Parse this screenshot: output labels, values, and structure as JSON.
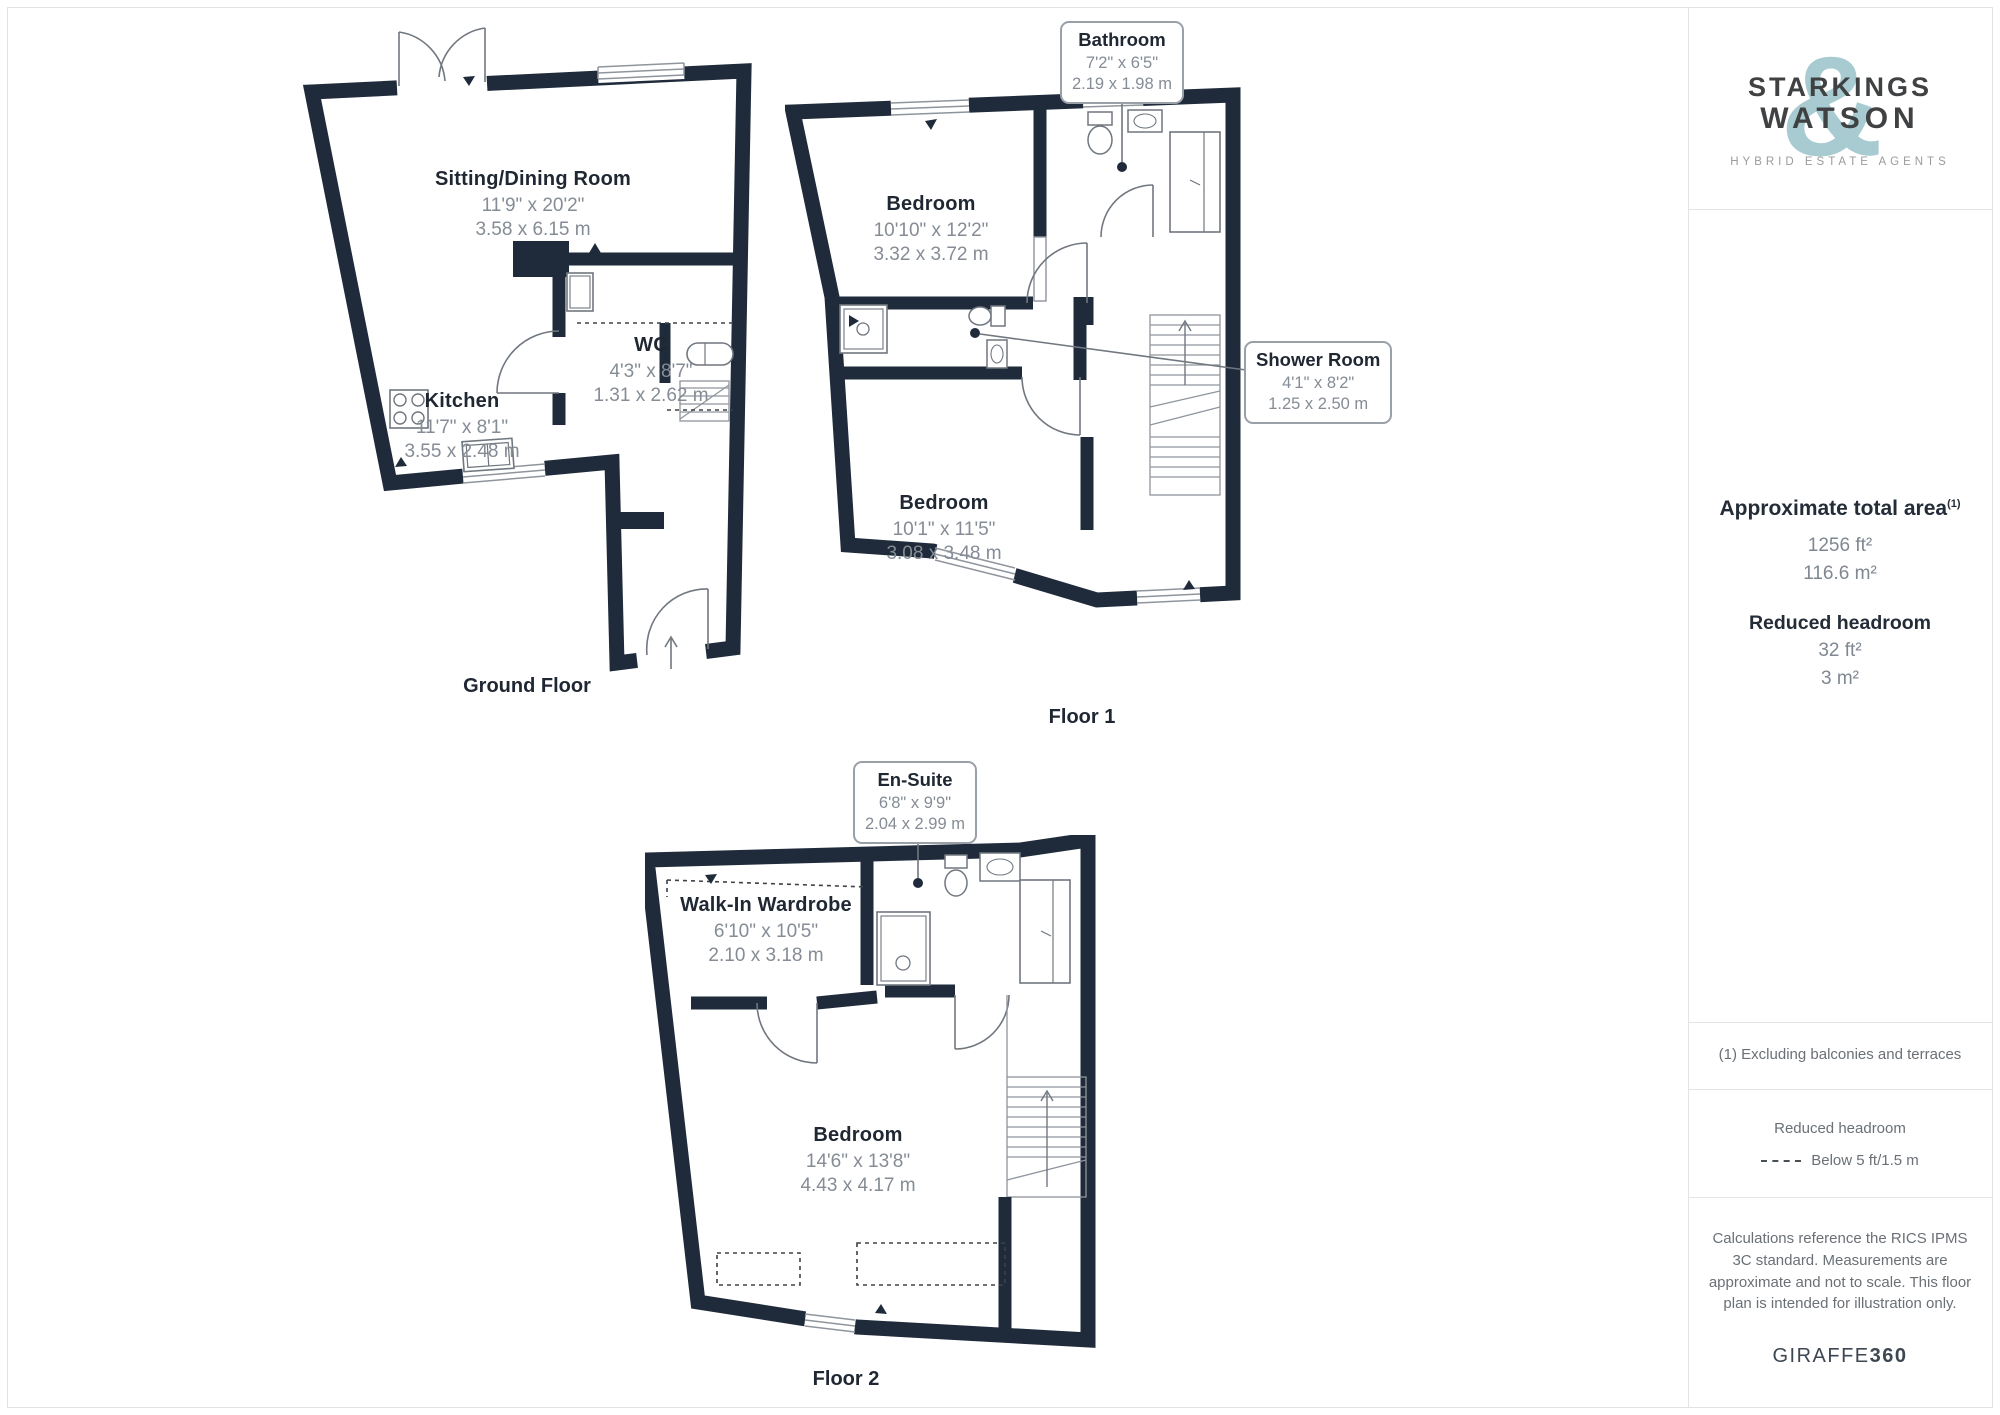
{
  "brand": {
    "name_top": "STARKINGS",
    "name_bottom": "WATSON",
    "ampersand": "&",
    "tagline": "HYBRID ESTATE AGENTS"
  },
  "sidebar": {
    "total_area_title": "Approximate total area",
    "total_area_superscript": "(1)",
    "total_area_imperial": "1256 ft²",
    "total_area_metric": "116.6 m²",
    "reduced_headroom_title": "Reduced headroom",
    "reduced_headroom_imperial": "32 ft²",
    "reduced_headroom_metric": "3 m²",
    "footnote": "(1) Excluding balconies and terraces",
    "legend_title": "Reduced headroom",
    "legend_label": "Below 5 ft/1.5 m",
    "disclaimer": "Calculations reference the RICS IPMS 3C standard. Measurements are approximate and not to scale. This floor plan is intended for illustration only.",
    "provider_name": "GIRAFFE",
    "provider_suffix": "360"
  },
  "floors": [
    {
      "caption": "Ground Floor",
      "rooms": [
        {
          "name": "Sitting/Dining Room",
          "imperial": "11'9\" x 20'2\"",
          "metric": "3.58 x 6.15 m"
        },
        {
          "name": "Kitchen",
          "imperial": "11'7\" x 8'1\"",
          "metric": "3.55 x 2.48 m"
        },
        {
          "name": "WC",
          "imperial": "4'3\" x 8'7\"",
          "metric": "1.31 x 2.62 m"
        }
      ]
    },
    {
      "caption": "Floor 1",
      "rooms": [
        {
          "name": "Bedroom",
          "imperial": "10'10\" x 12'2\"",
          "metric": "3.32 x 3.72 m"
        },
        {
          "name": "Bedroom",
          "imperial": "10'1\" x 11'5\"",
          "metric": "3.08 x 3.48 m"
        }
      ],
      "callouts": [
        {
          "name": "Bathroom",
          "imperial": "7'2\" x 6'5\"",
          "metric": "2.19 x 1.98 m"
        },
        {
          "name": "Shower Room",
          "imperial": "4'1\" x 8'2\"",
          "metric": "1.25 x 2.50 m"
        }
      ]
    },
    {
      "caption": "Floor 2",
      "rooms": [
        {
          "name": "Walk-In Wardrobe",
          "imperial": "6'10\" x 10'5\"",
          "metric": "2.10 x 3.18 m"
        },
        {
          "name": "Bedroom",
          "imperial": "14'6\" x 13'8\"",
          "metric": "4.43 x 4.17 m"
        }
      ],
      "callouts": [
        {
          "name": "En-Suite",
          "imperial": "6'8\" x 9'9\"",
          "metric": "2.04 x 2.99 m"
        }
      ]
    }
  ],
  "colors": {
    "wall": "#1f2b3a",
    "accent": "#a7cbd1",
    "text_dark": "#1f2733",
    "text_gray": "#858c95"
  }
}
